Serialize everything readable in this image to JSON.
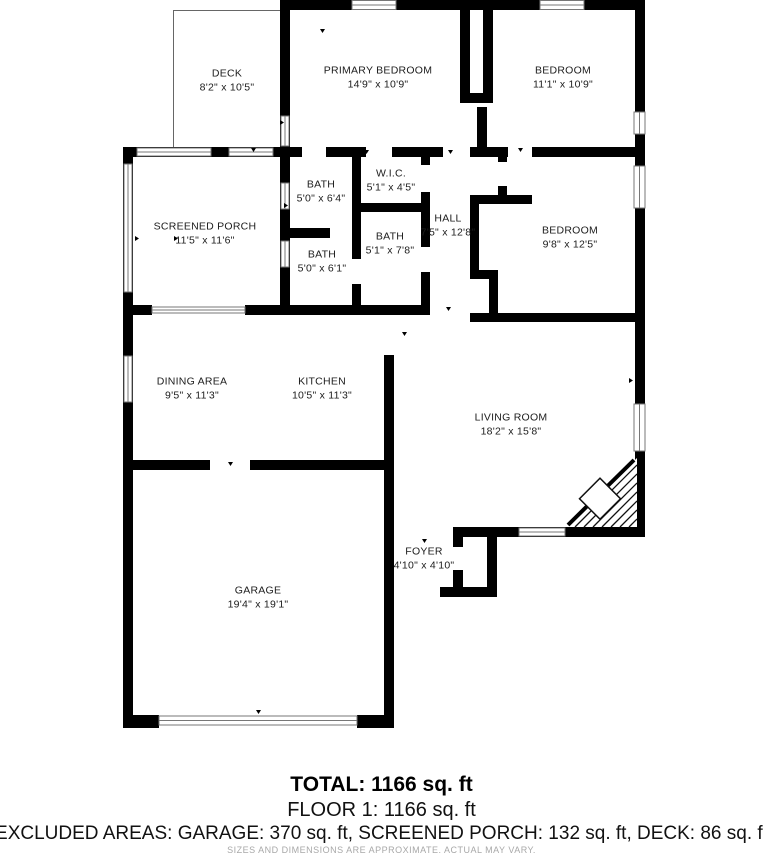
{
  "plan_title": "Floor plan",
  "rooms": [
    {
      "id": "deck",
      "name": "DECK",
      "dims": "8'2\" x 10'5\""
    },
    {
      "id": "primary-bedroom",
      "name": "PRIMARY BEDROOM",
      "dims": "14'9\" x 10'9\""
    },
    {
      "id": "bedroom-top",
      "name": "BEDROOM",
      "dims": "11'1\" x 10'9\""
    },
    {
      "id": "screened-porch",
      "name": "SCREENED PORCH",
      "dims": "11'5\" x 11'6\""
    },
    {
      "id": "bath-1",
      "name": "BATH",
      "dims": "5'0\" x 6'4\""
    },
    {
      "id": "wic",
      "name": "W.I.C.",
      "dims": "5'1\" x 4'5\""
    },
    {
      "id": "bath-2",
      "name": "BATH",
      "dims": "5'1\" x 7'8\""
    },
    {
      "id": "bath-3",
      "name": "BATH",
      "dims": "5'0\" x 6'1\""
    },
    {
      "id": "hall",
      "name": "HALL",
      "dims": "7'5\" x 12'8\""
    },
    {
      "id": "bedroom-right",
      "name": "BEDROOM",
      "dims": "9'8\" x 12'5\""
    },
    {
      "id": "dining-area",
      "name": "DINING AREA",
      "dims": "9'5\" x 11'3\""
    },
    {
      "id": "kitchen",
      "name": "KITCHEN",
      "dims": "10'5\" x 11'3\""
    },
    {
      "id": "living-room",
      "name": "LIVING ROOM",
      "dims": "18'2\" x 15'8\""
    },
    {
      "id": "foyer",
      "name": "FOYER",
      "dims": "4'10\" x 4'10\""
    },
    {
      "id": "garage",
      "name": "GARAGE",
      "dims": "19'4\" x 19'1\""
    }
  ],
  "summary": {
    "total": "TOTAL: 1166 sq. ft",
    "floor1": "FLOOR 1: 1166 sq. ft",
    "excluded": "EXCLUDED AREAS: GARAGE: 370 sq. ft, SCREENED PORCH: 132 sq. ft, DECK: 86 sq. ft",
    "disclaimer": "SIZES AND DIMENSIONS ARE APPROXIMATE. ACTUAL MAY VARY."
  },
  "colors": {
    "wall": "#000000",
    "background": "#ffffff",
    "label_text": "#1c1c1c",
    "window_outline": "#777777",
    "disclaimer_text": "#a8a8a8"
  }
}
